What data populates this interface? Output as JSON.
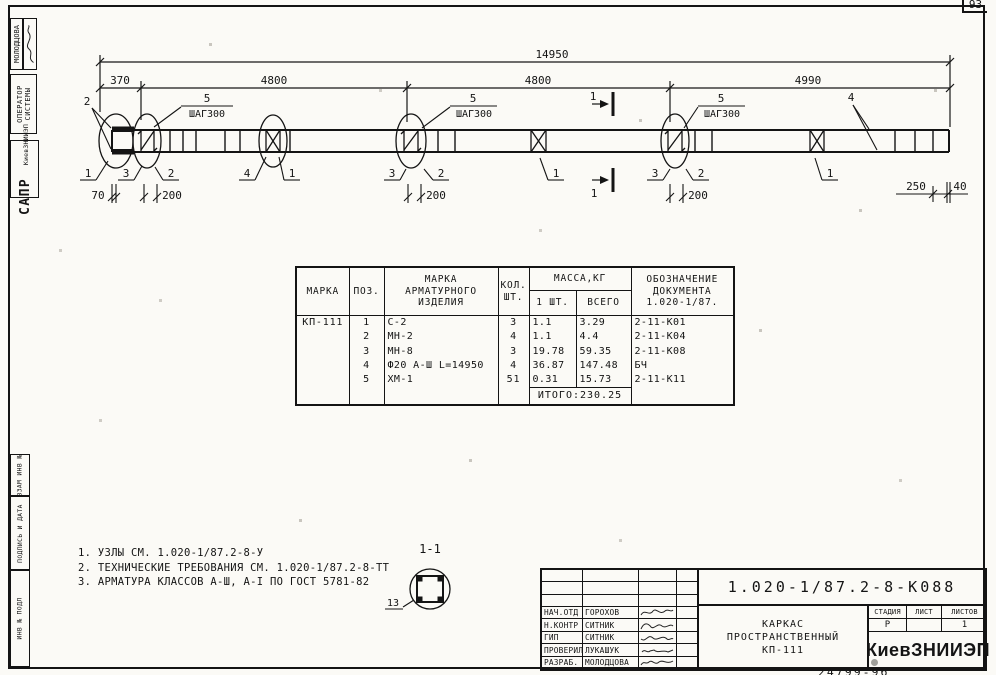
{
  "page": {
    "corner_number": "93",
    "bottom_number": "24799-96"
  },
  "stamps": {
    "designer": "МОЛОДЦОВА",
    "operator1": "ОПЕРАТОР",
    "operator2": "СИСТЕМЫ",
    "sapr": "САПР",
    "sapr_org": "КиевЗНИИЭП",
    "vzam": "ВЗАМ ИНВ №",
    "podpis": "ПОДПИСЬ И ДАТА",
    "inv": "ИНВ № ПОДЛ"
  },
  "dims": {
    "total": "14950",
    "seg1": "370",
    "seg2": "4800",
    "seg3": "4800",
    "seg4": "4990",
    "b70": "70",
    "b200": "200",
    "b250": "250",
    "b40": "40"
  },
  "marks": {
    "m1": "1",
    "m2": "2",
    "m3": "3",
    "m4": "4",
    "m5": "5",
    "shag": "ШАГ300",
    "cut": "1"
  },
  "section": {
    "title": "1-1",
    "pos13": "13"
  },
  "notes": {
    "n1": "1. УЗЛЫ СМ. 1.020-1/87.2-8-У",
    "n2": "2. ТЕХНИЧЕСКИЕ ТРЕБОВАНИЯ СМ. 1.020-1/87.2-8-ТТ",
    "n3": "3. АРМАТУРА КЛАССОВ А-Ш, А-I ПО ГОСТ 5781-82"
  },
  "table": {
    "h_marka": "МАРКА",
    "h_poz": "ПОЗ.",
    "h_item1": "МАРКА",
    "h_item2": "АРМАТУРНОГО",
    "h_item3": "ИЗДЕЛИЯ",
    "h_qty1": "КОЛ.",
    "h_qty2": "ШТ.",
    "h_mass": "МАССА,КГ",
    "h_mass_one": "1 ШТ.",
    "h_mass_all": "ВСЕГО",
    "h_doc1": "ОБОЗНАЧЕНИЕ",
    "h_doc2": "ДОКУМЕНТА",
    "h_doc3": "1.020-1/87.",
    "mark": "КП-111",
    "rows": [
      {
        "poz": "1",
        "item": "С-2",
        "qty": "3",
        "m1": "1.1",
        "mall": "3.29",
        "doc": "2-11-К01"
      },
      {
        "poz": "2",
        "item": "МН-2",
        "qty": "4",
        "m1": "1.1",
        "mall": "4.4",
        "doc": "2-11-К04"
      },
      {
        "poz": "3",
        "item": "МН-8",
        "qty": "3",
        "m1": "19.78",
        "mall": "59.35",
        "doc": "2-11-К08"
      },
      {
        "poz": "4",
        "item": "Ф20 А-Ш L=14950",
        "qty": "4",
        "m1": "36.87",
        "mall": "147.48",
        "doc": "БЧ"
      },
      {
        "poz": "5",
        "item": "ХМ-1",
        "qty": "51",
        "m1": "0.31",
        "mall": "15.73",
        "doc": "2-11-К11"
      }
    ],
    "total": "ИТОГО:230.25"
  },
  "titleblock": {
    "doc_number": "1.020-1/87.2-8-К088",
    "title1": "КАРКАС",
    "title2": "ПРОСТРАНСТВЕННЫЙ",
    "title3": "КП-111",
    "stage_label": "СТАДИЯ",
    "sheet_label": "ЛИСТ",
    "sheets_label": "ЛИСТОВ",
    "stage": "Р",
    "sheets": "1",
    "org": "КиевЗНИИЭП",
    "signers": [
      {
        "role": "НАЧ.ОТД",
        "name": "ГОРОХОВ"
      },
      {
        "role": "Н.КОНТР",
        "name": "СИТНИК"
      },
      {
        "role": "ГИП",
        "name": "СИТНИК"
      },
      {
        "role": "ПРОВЕРИЛ",
        "name": "ЛУКАШУК"
      },
      {
        "role": "РАЗРАБ.",
        "name": "МОЛОДЦОВА"
      }
    ]
  }
}
